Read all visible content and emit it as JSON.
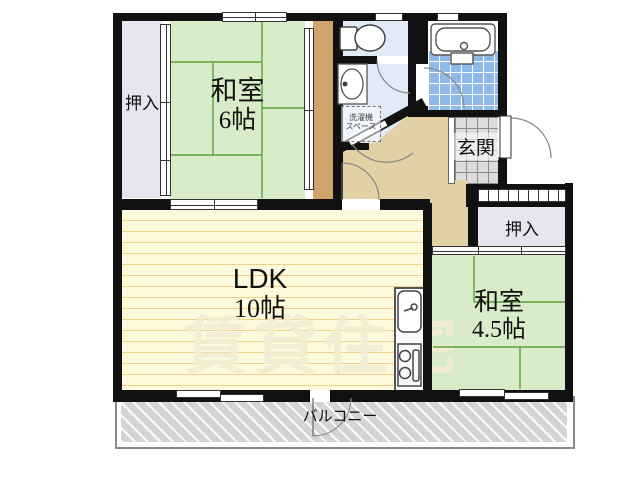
{
  "plan": {
    "rooms": {
      "washitsu6": {
        "name": "和室",
        "size": "6帖"
      },
      "ldk": {
        "name": "LDK",
        "size": "10帖"
      },
      "washitsu45": {
        "name": "和室",
        "size": "4.5帖"
      },
      "closet_top_left": "押入",
      "closet_right": "押入",
      "genkan": "玄関",
      "balcony": "バルコニー",
      "laundry_line1": "洗濯機",
      "laundry_line2": "スペース"
    },
    "watermark": "賃貸住宅",
    "colors": {
      "tatami_green": "#d9ecca",
      "tatami_line": "#5aa23e",
      "ldk_floor": "#fdf9dc",
      "ldk_stripe": "#f3cf8a",
      "closet_lavender": "#e7e3ef",
      "hall_beige": "#e3d1a6",
      "corridor_brown": "#d0a36b",
      "wet_area_blue": "#e0ebf7",
      "bath_tile_blue": "#8fb9e9",
      "genkan_tile_gray": "#dcdcdc",
      "balcony_gray": "#d4d4d4",
      "wall_black": "#111111"
    }
  }
}
